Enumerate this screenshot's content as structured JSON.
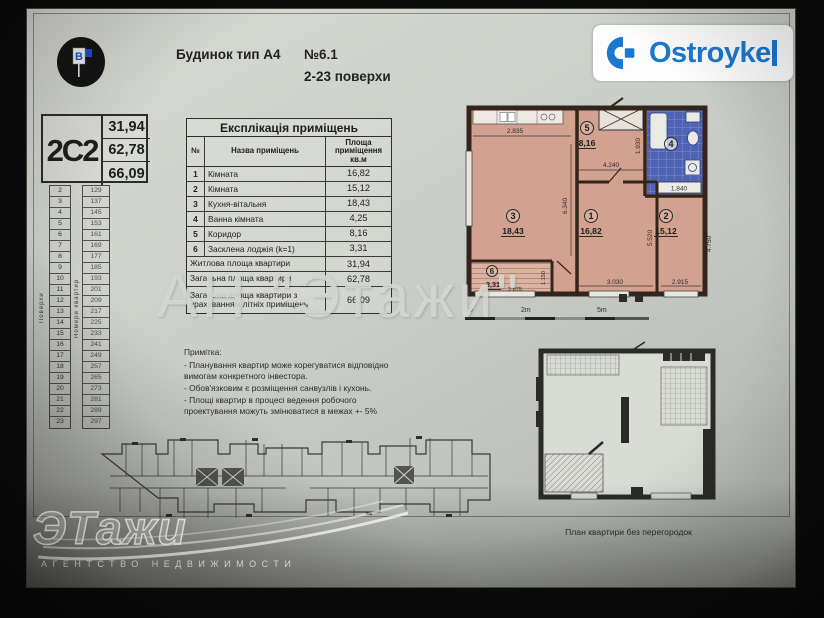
{
  "header": {
    "building_type": "Будинок тип А4",
    "apartment_no": "№6.1",
    "floors_range": "2-23 поверхи",
    "flag_letter": "B",
    "brand": "Ostroyke"
  },
  "apartment_card": {
    "type_code": "2С2",
    "living_area": "31,94",
    "total_area": "62,78",
    "total_area_summer": "66,09"
  },
  "floors_table": {
    "floors_label": "Поверхи",
    "apts_label": "Номери квартир",
    "rows": [
      {
        "floor": "2",
        "apt": "129"
      },
      {
        "floor": "3",
        "apt": "137"
      },
      {
        "floor": "4",
        "apt": "145"
      },
      {
        "floor": "5",
        "apt": "153"
      },
      {
        "floor": "6",
        "apt": "161"
      },
      {
        "floor": "7",
        "apt": "169"
      },
      {
        "floor": "8",
        "apt": "177"
      },
      {
        "floor": "9",
        "apt": "185"
      },
      {
        "floor": "10",
        "apt": "193"
      },
      {
        "floor": "11",
        "apt": "201"
      },
      {
        "floor": "12",
        "apt": "209"
      },
      {
        "floor": "13",
        "apt": "217"
      },
      {
        "floor": "14",
        "apt": "225"
      },
      {
        "floor": "15",
        "apt": "233"
      },
      {
        "floor": "16",
        "apt": "241"
      },
      {
        "floor": "17",
        "apt": "249"
      },
      {
        "floor": "18",
        "apt": "257"
      },
      {
        "floor": "19",
        "apt": "265"
      },
      {
        "floor": "20",
        "apt": "273"
      },
      {
        "floor": "21",
        "apt": "281"
      },
      {
        "floor": "22",
        "apt": "289"
      },
      {
        "floor": "23",
        "apt": "297"
      }
    ]
  },
  "explication": {
    "title": "Експлікація приміщень",
    "col_no": "№",
    "col_name": "Назва приміщень",
    "col_area": "Площа приміщення кв.м",
    "rows": [
      [
        "1",
        "Кімната",
        "16,82"
      ],
      [
        "2",
        "Кімната",
        "15,12"
      ],
      [
        "3",
        "Кухня-вітальня",
        "18,43"
      ],
      [
        "4",
        "Ванна кімната",
        "4,25"
      ],
      [
        "5",
        "Коридор",
        "8,16"
      ],
      [
        "6",
        "Засклена лоджія (k=1)",
        "3,31"
      ]
    ],
    "summary": [
      [
        "Житлова площа квартири",
        "31,94"
      ],
      [
        "Загальна площа квартири",
        "62,78"
      ],
      [
        "Загальна площа квартири з урахуванням літніх приміщень",
        "66,09"
      ]
    ]
  },
  "notes": {
    "title": "Примітка:",
    "items": [
      "- Планування квартир може корегуватися відповідно вимогам конкретного інвестора.",
      "- Обов'язковим є розміщення санвузлів і кухонь.",
      "- Площі квартир в процесі ведення робочого проектування можуть змінюватися в межах +- 5%"
    ]
  },
  "plan": {
    "rooms": [
      {
        "num": "1",
        "area": "16,82"
      },
      {
        "num": "2",
        "area": "15,12"
      },
      {
        "num": "3",
        "area": "18,43"
      },
      {
        "num": "4",
        "area": "4,25"
      },
      {
        "num": "5",
        "area": "8,16"
      },
      {
        "num": "6",
        "area": "3,31"
      }
    ],
    "dims": {
      "w_room3": "2.835",
      "h_room3": "6.340",
      "w_hall": "4.240",
      "w_bath": "1.930",
      "bath_len": "1.840",
      "h_room1": "5.520",
      "h_room2": "4.750",
      "w_room1": "3.030",
      "w_room2": "2.915",
      "w_loggia": "2.875",
      "d_loggia": "1.150"
    },
    "scale": {
      "zero": "0",
      "two": "2m",
      "five": "5m"
    }
  },
  "open_plan": {
    "caption": "План квартири без перегородок"
  },
  "watermarks": {
    "center": "АН \"Этажи\"",
    "logo_text": "ЭТажи",
    "logo_subtitle": "АГЕНТСТВО  НЕДВИЖИМОСТИ"
  },
  "colors": {
    "brand_blue": "#1b78d0",
    "plan_room_fill": "#d2a18f",
    "plan_wall": "#33251b",
    "bath_blue": "#4e63b5",
    "page_bg": "#cbcec8"
  }
}
